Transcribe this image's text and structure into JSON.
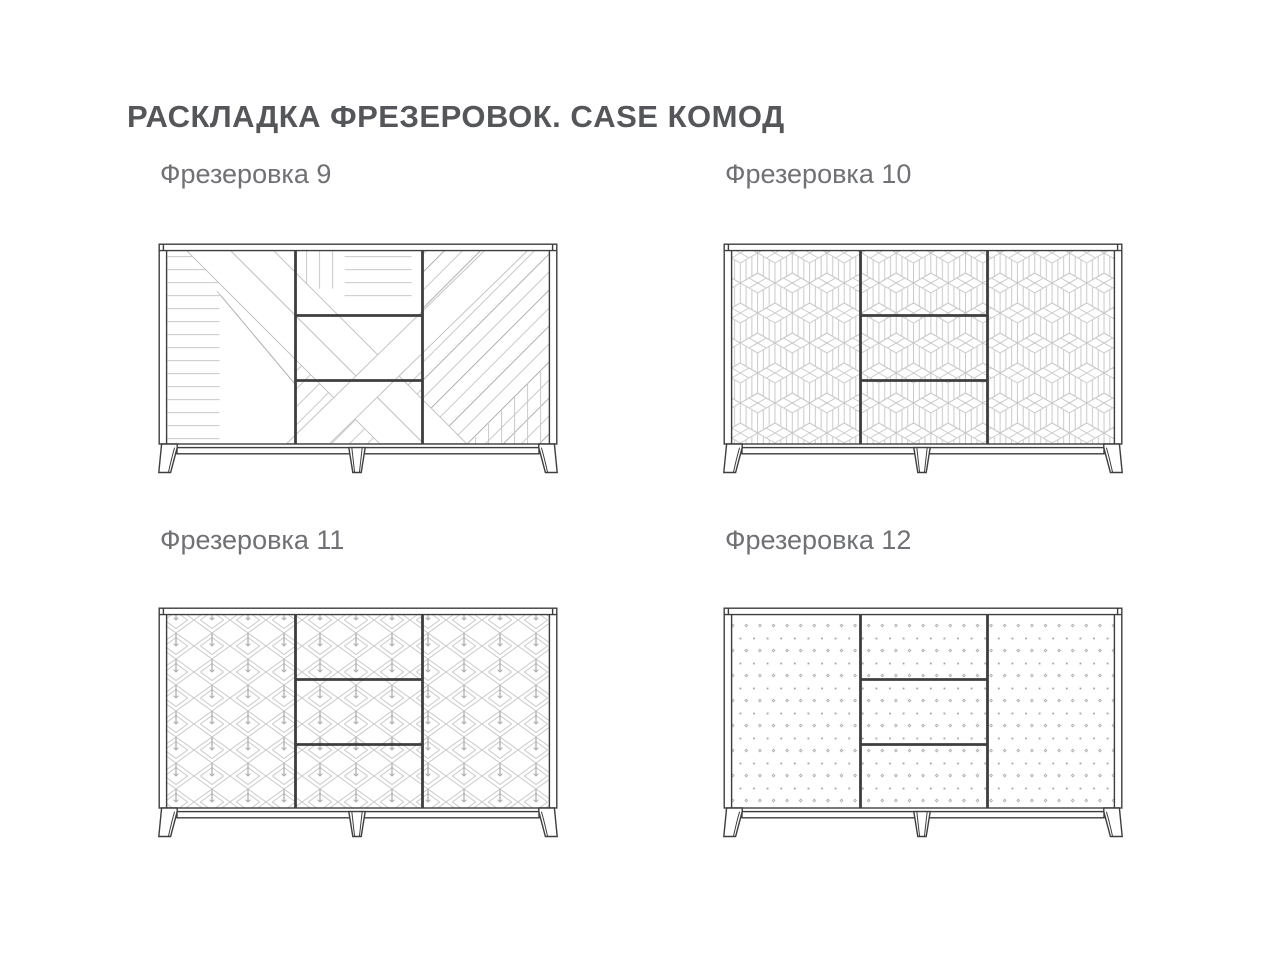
{
  "page": {
    "title": "РАСКЛАДКА ФРЕЗЕРОВОК. CASE КОМОД",
    "background": "#ffffff"
  },
  "colors": {
    "title_text": "#55565a",
    "label_text": "#707175",
    "outline": "#3d3e40",
    "pattern_light": "#c9c9c9",
    "pattern_medium": "#b0b0b0",
    "pattern_dark": "#9a9a9a"
  },
  "variants": [
    {
      "id": "9",
      "label": "Фрезеровка 9",
      "pattern": "diagonal-stripe-composition"
    },
    {
      "id": "10",
      "label": "Фрезеровка 10",
      "pattern": "isometric-cubes"
    },
    {
      "id": "11",
      "label": "Фрезеровка 11",
      "pattern": "nested-diamond-leaf"
    },
    {
      "id": "12",
      "label": "Фрезеровка 12",
      "pattern": "dot-grid"
    }
  ]
}
